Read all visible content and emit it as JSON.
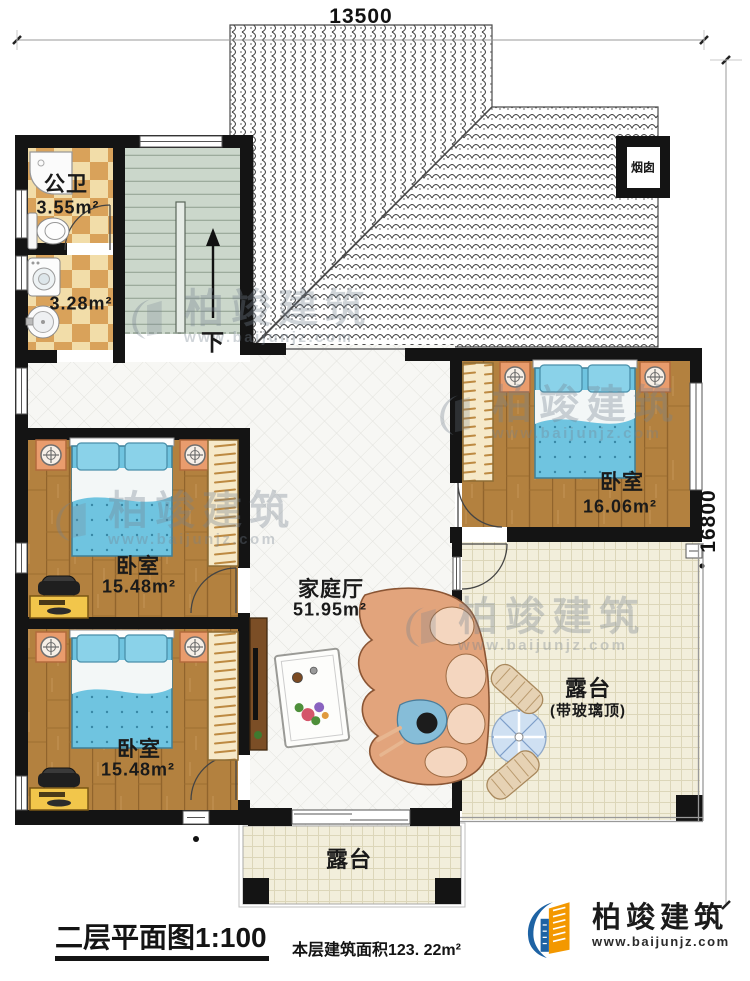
{
  "dimensions": {
    "width_top": "13500",
    "height_right": "16800"
  },
  "rooms": {
    "bathroom": {
      "name": "公卫",
      "area": "3.55m²"
    },
    "laundry": {
      "area": "3.28m²"
    },
    "bedroom_top_right": {
      "name": "卧室",
      "area": "16.06m²"
    },
    "bedroom_middle_left": {
      "name": "卧室",
      "area": "15.48m²"
    },
    "bedroom_bottom_left": {
      "name": "卧室",
      "area": "15.48m²"
    },
    "family_hall": {
      "name": "家庭厅",
      "area": "51.95m²"
    },
    "terrace_right": {
      "name": "露台",
      "note": "(带玻璃顶)"
    },
    "terrace_bottom": {
      "name": "露台"
    }
  },
  "annotations": {
    "chimney": "烟囱",
    "stairs_down": "下"
  },
  "footer": {
    "plan_title": "二层平面图",
    "plan_scale": "1:100",
    "floor_area_label": "本层建筑面积123. 22m²",
    "brand_name": "柏竣建筑",
    "brand_site": "www.baijunjz.com"
  },
  "watermark": {
    "brand": "柏竣建筑",
    "site": "www.baijunjz.com"
  },
  "colors": {
    "wall": "#141414",
    "wood_floor": "#b3813f",
    "bed_blue": "#6fc4e0",
    "checker_tan": "#d9a25a",
    "stairs_green": "#cbd7cb",
    "terrace_cream": "#f2eedb",
    "brand_blue": "#1e63a4",
    "brand_orange": "#f39800"
  }
}
